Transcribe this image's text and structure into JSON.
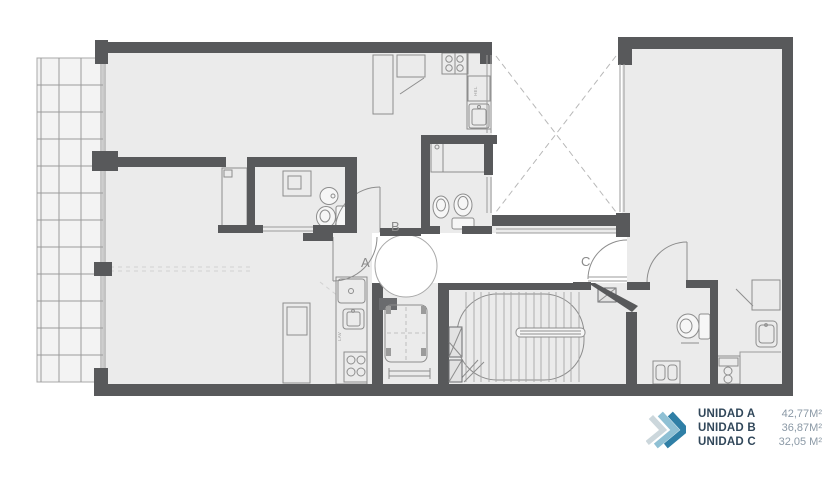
{
  "legend": {
    "items": [
      {
        "label": "UNIDAD A",
        "value": "42,77M²"
      },
      {
        "label": "UNIDAD B",
        "value": "36,87M²"
      },
      {
        "label": "UNIDAD C",
        "value": "32,05 M²"
      }
    ]
  },
  "plan": {
    "door_labels": {
      "a": "A",
      "b": "B",
      "c": "C"
    },
    "fixture_labels": {
      "sink": "LAV",
      "fridge": "HEL"
    },
    "colors": {
      "wall": "#58595b",
      "floor": "#ebebeb",
      "chevron_dark": "#2f7fa6",
      "chevron_light": "#8fc0d4"
    }
  }
}
